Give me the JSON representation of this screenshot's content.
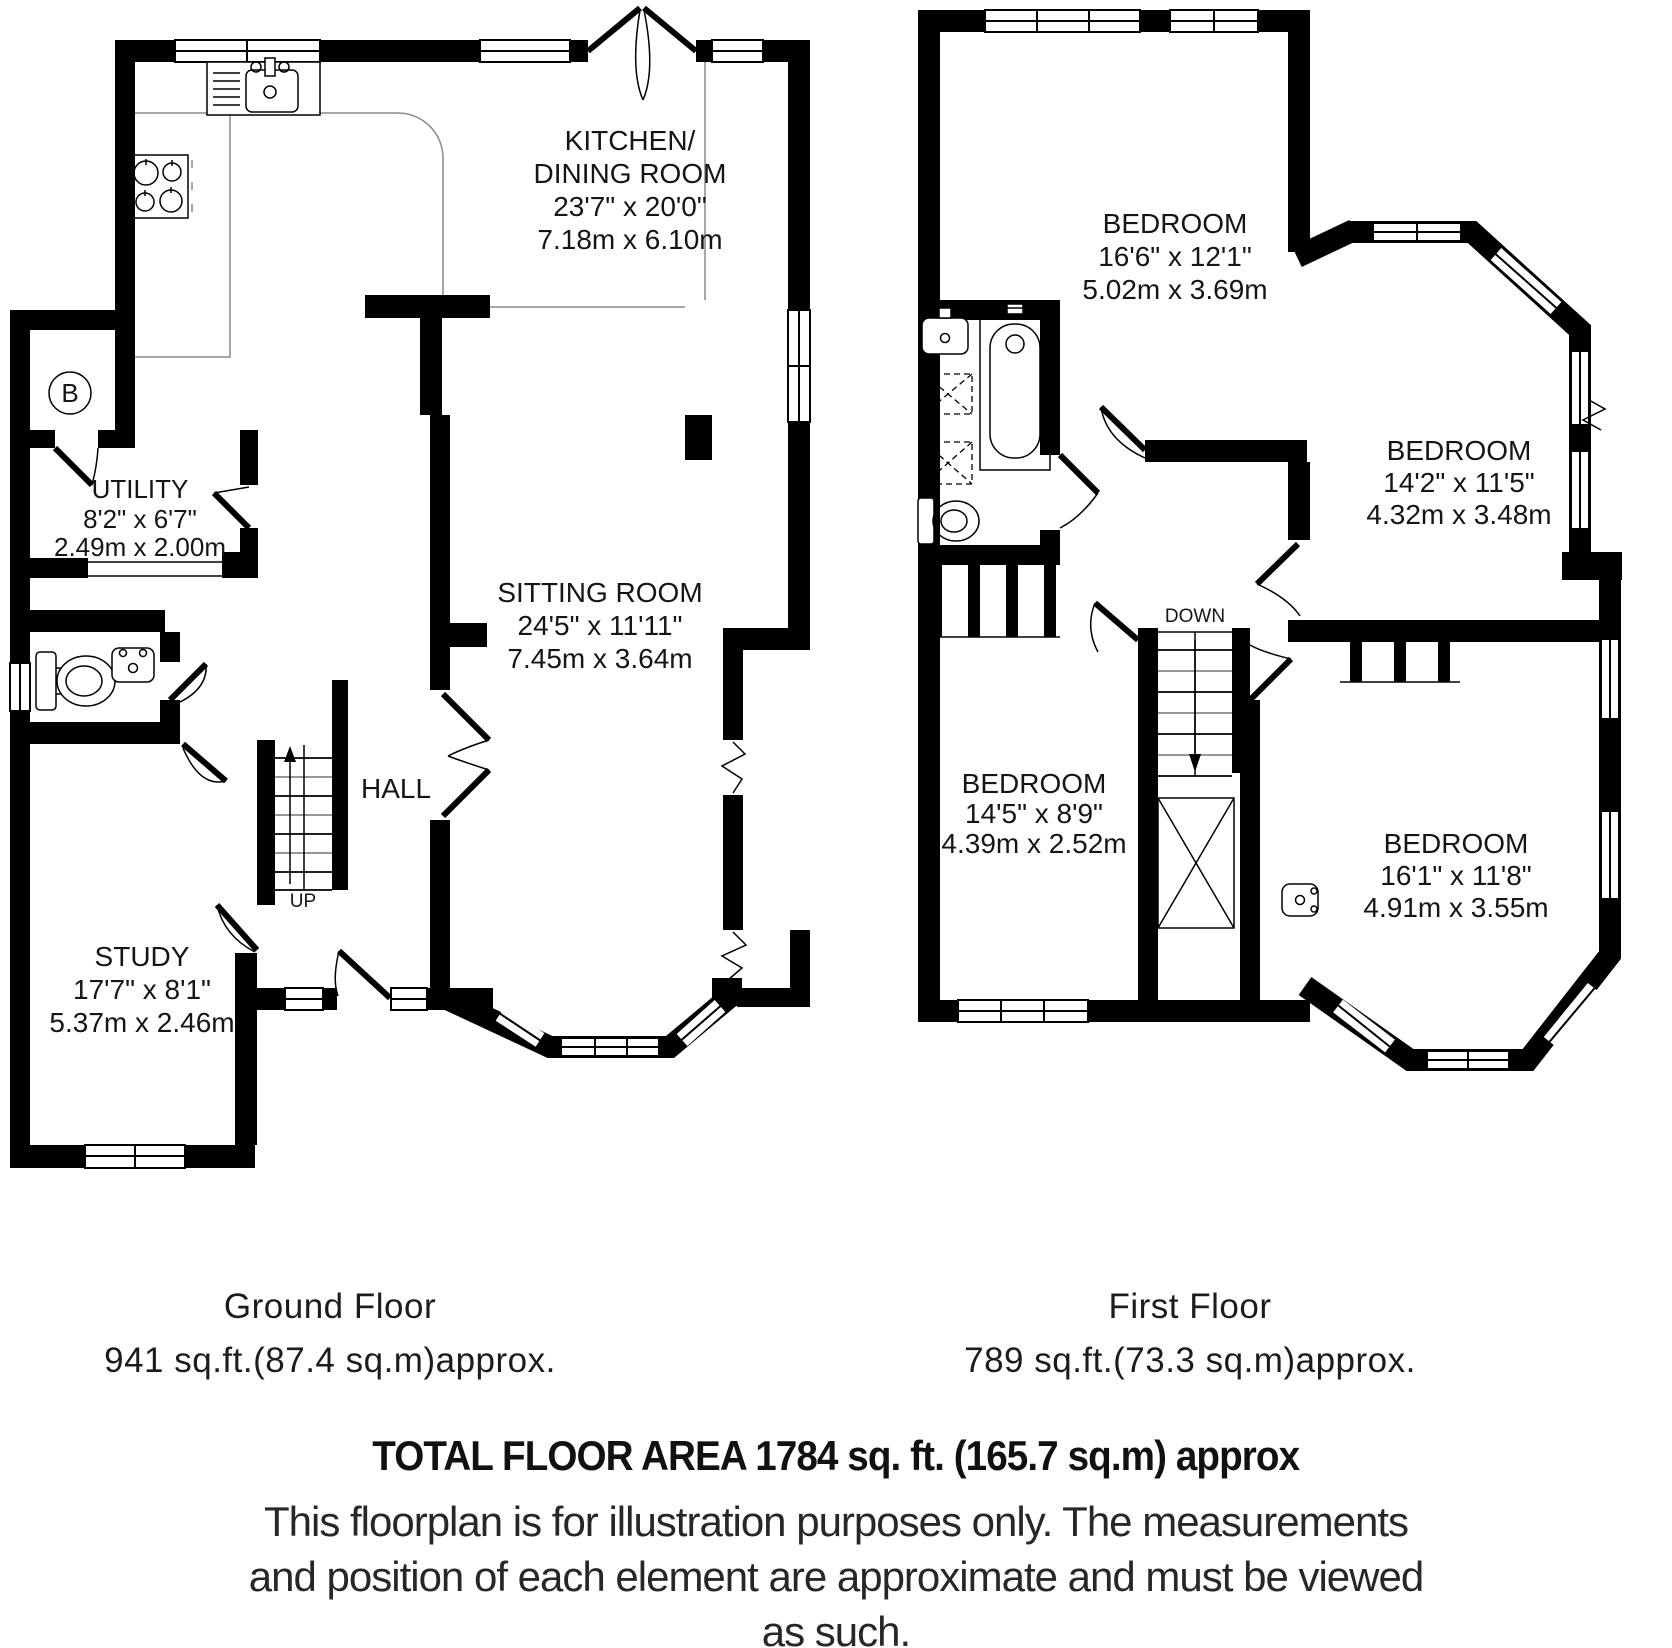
{
  "ground_floor": {
    "caption": {
      "title": "Ground Floor",
      "area": "941 sq.ft.(87.4 sq.m)approx."
    },
    "stairs_label": "UP",
    "boiler_label": "B",
    "rooms": {
      "kitchen_dining": {
        "name_line1": "KITCHEN/",
        "name_line2": "DINING ROOM",
        "dims_imperial": "23'7\" x 20'0\"",
        "dims_metric": "7.18m x 6.10m"
      },
      "utility": {
        "name": "UTILITY",
        "dims_imperial": "8'2\" x 6'7\"",
        "dims_metric": "2.49m x 2.00m"
      },
      "sitting_room": {
        "name": "SITTING ROOM",
        "dims_imperial": "24'5\" x 11'11\"",
        "dims_metric": "7.45m x 3.64m"
      },
      "hall": {
        "name": "HALL"
      },
      "study": {
        "name": "STUDY",
        "dims_imperial": "17'7\" x 8'1\"",
        "dims_metric": "5.37m x 2.46m"
      }
    }
  },
  "first_floor": {
    "caption": {
      "title": "First Floor",
      "area": "789 sq.ft.(73.3 sq.m)approx."
    },
    "stairs_label": "DOWN",
    "rooms": {
      "bedroom_top": {
        "name": "BEDROOM",
        "dims_imperial": "16'6\" x 12'1\"",
        "dims_metric": "5.02m x 3.69m"
      },
      "bedroom_right": {
        "name": "BEDROOM",
        "dims_imperial": "14'2\" x 11'5\"",
        "dims_metric": "4.32m x 3.48m"
      },
      "bedroom_bottom_left": {
        "name": "BEDROOM",
        "dims_imperial": "14'5\" x 8'9\"",
        "dims_metric": "4.39m x 2.52m"
      },
      "bedroom_bottom_right": {
        "name": "BEDROOM",
        "dims_imperial": "16'1\" x 11'8\"",
        "dims_metric": "4.91m x 3.55m"
      }
    }
  },
  "footer": {
    "total_area": "TOTAL FLOOR AREA 1784 sq. ft. (165.7 sq.m) approx",
    "disclaimer_line1": "This floorplan is for illustration purposes only. The measurements",
    "disclaimer_line2": "and position of each element are approximate and must be viewed",
    "disclaimer_line3": "as such."
  },
  "colors": {
    "wall": "#000000",
    "label_text": "#151515",
    "counter_line": "#8a8a8a"
  }
}
